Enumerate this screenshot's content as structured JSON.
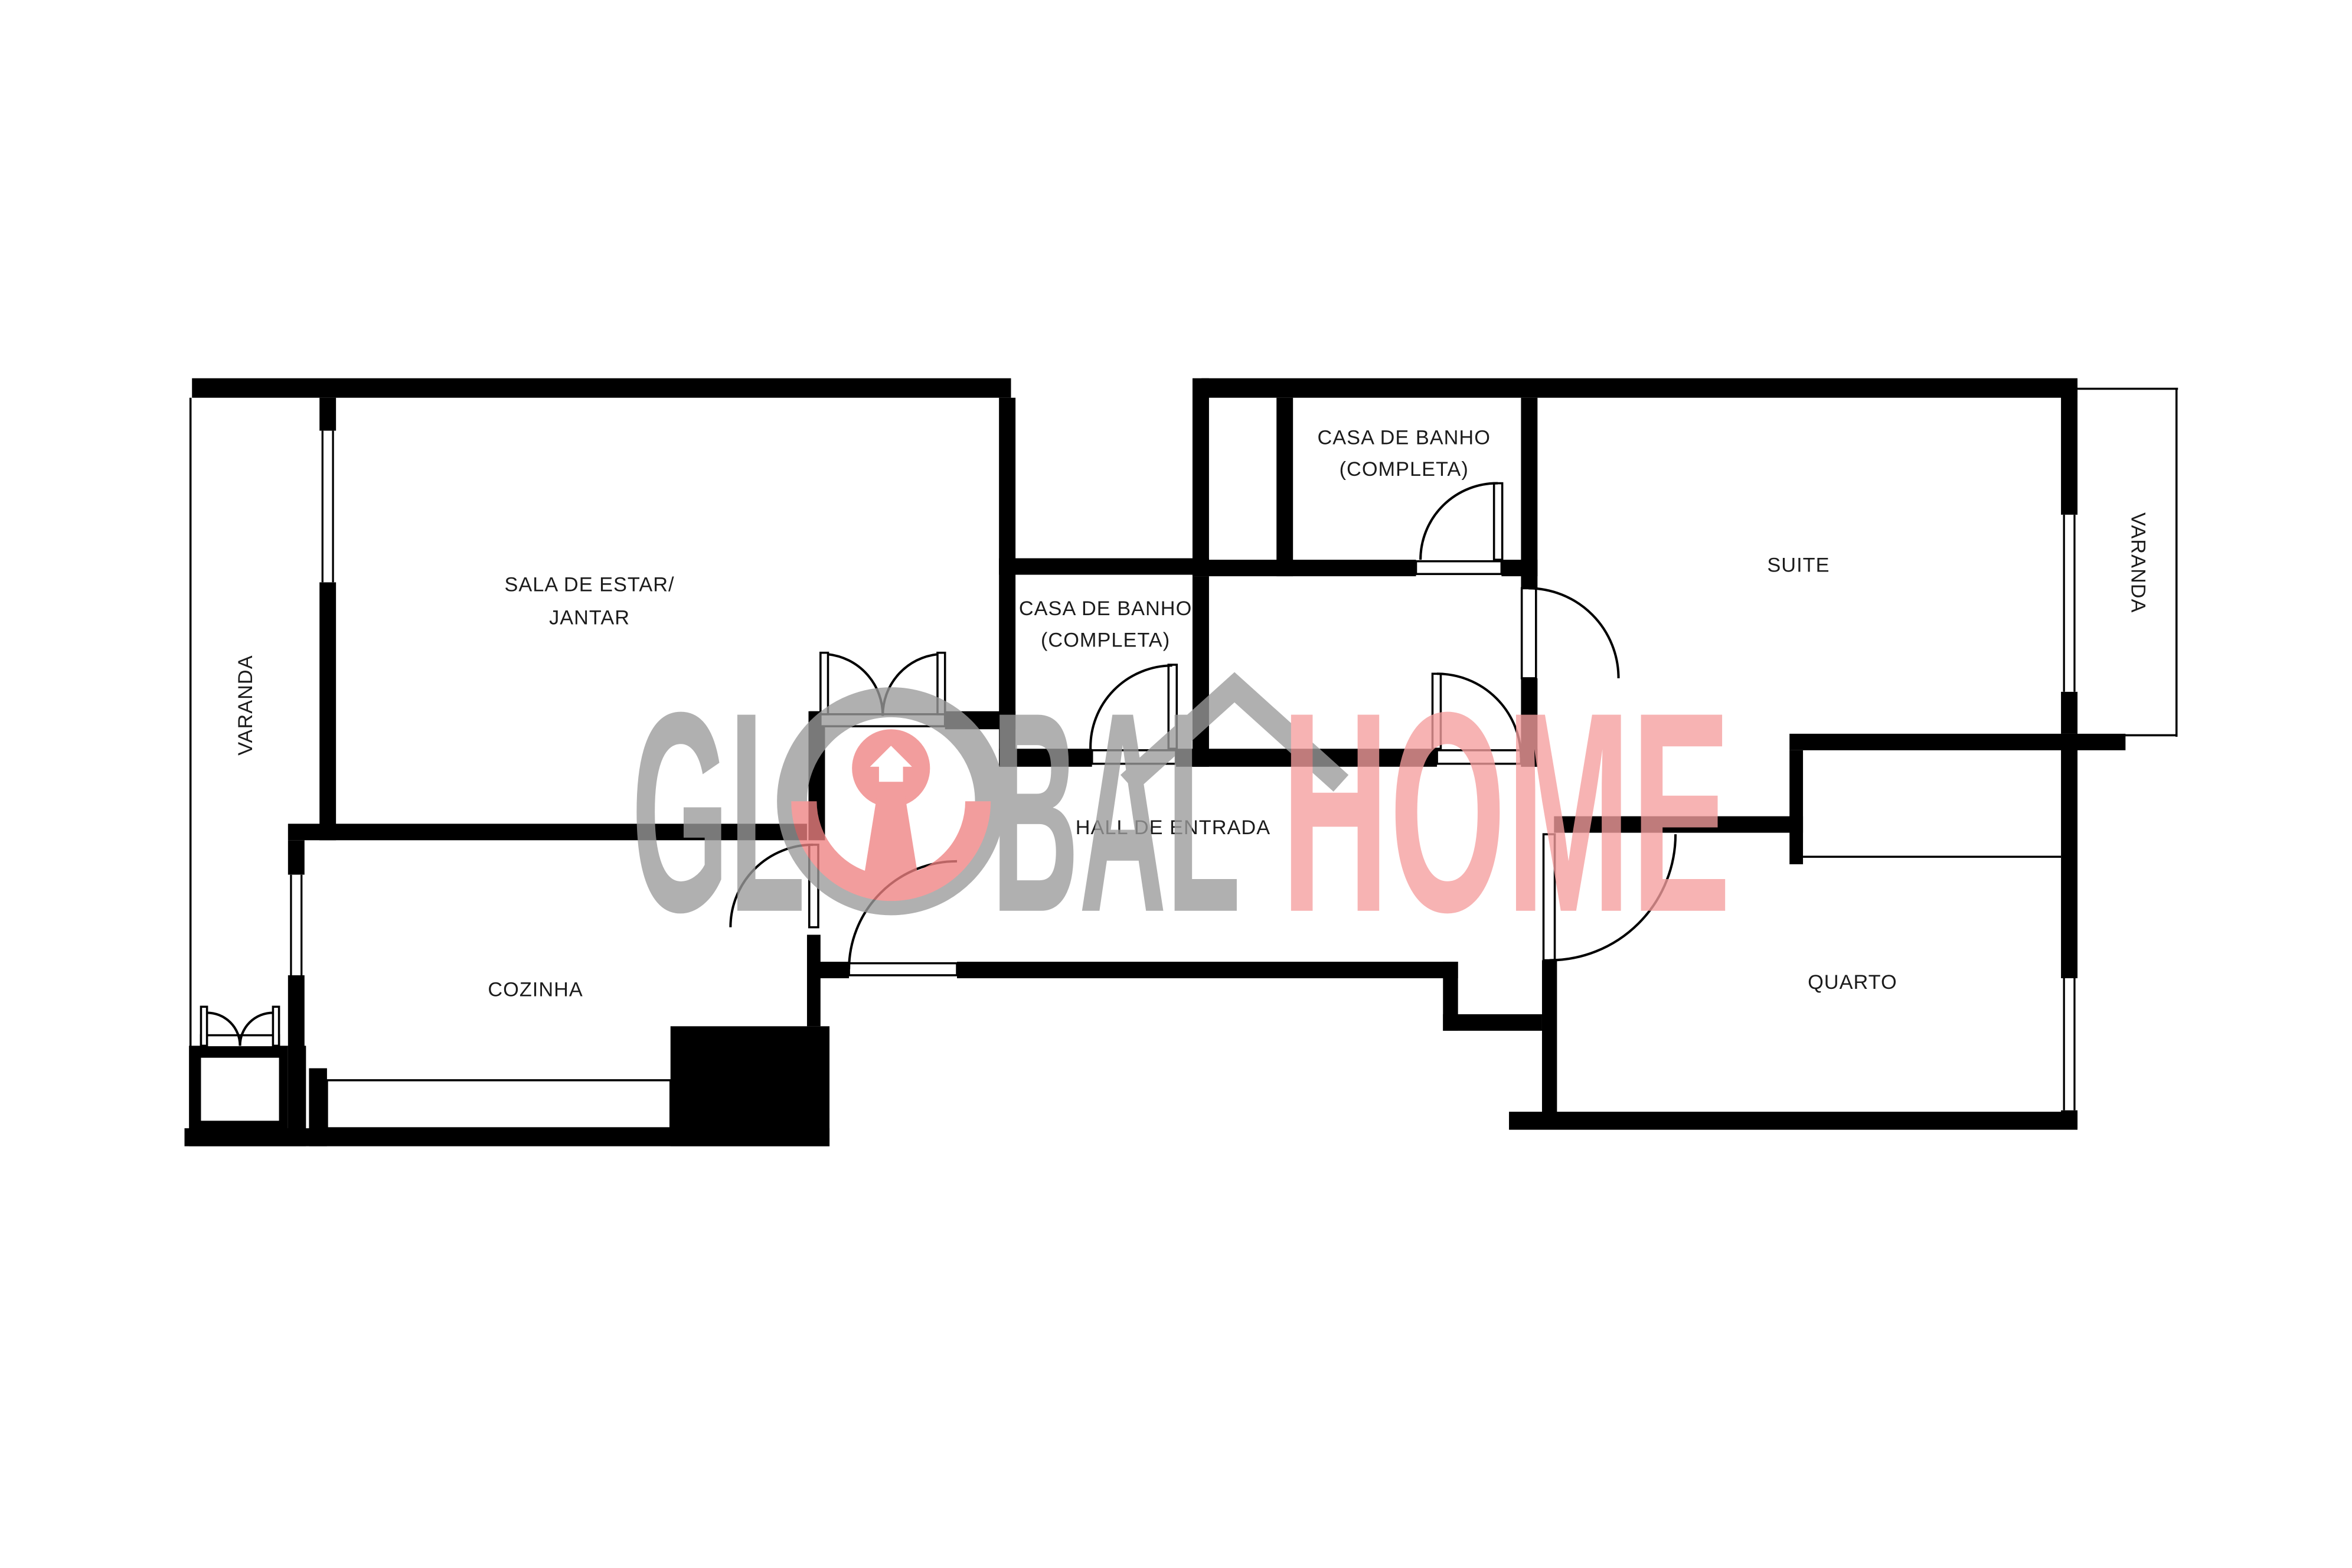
{
  "rooms": {
    "sala": {
      "line1": "SALA DE ESTAR/",
      "line2": "JANTAR"
    },
    "cozinha": {
      "label": "COZINHA"
    },
    "hall": {
      "label": "HALL DE ENTRADA"
    },
    "bathroom_middle": {
      "line1": "CASA DE BANHO",
      "line2": "(COMPLETA)"
    },
    "bathroom_top": {
      "line1": "CASA DE BANHO",
      "line2": "(COMPLETA)"
    },
    "suite": {
      "label": "SUITE"
    },
    "quarto": {
      "label": "QUARTO"
    },
    "varanda_left": {
      "label": "VARANDA"
    },
    "varanda_right": {
      "label": "VARANDA"
    }
  },
  "watermark": {
    "gl": "GL",
    "bal": "BAL",
    "home": "HOME",
    "colors": {
      "gray": "#9b9b9b",
      "pink": "#f59e9e",
      "red": "#ef8282"
    }
  },
  "colors": {
    "wall": "#000000",
    "background": "#ffffff",
    "label": "#1b1b1b"
  }
}
